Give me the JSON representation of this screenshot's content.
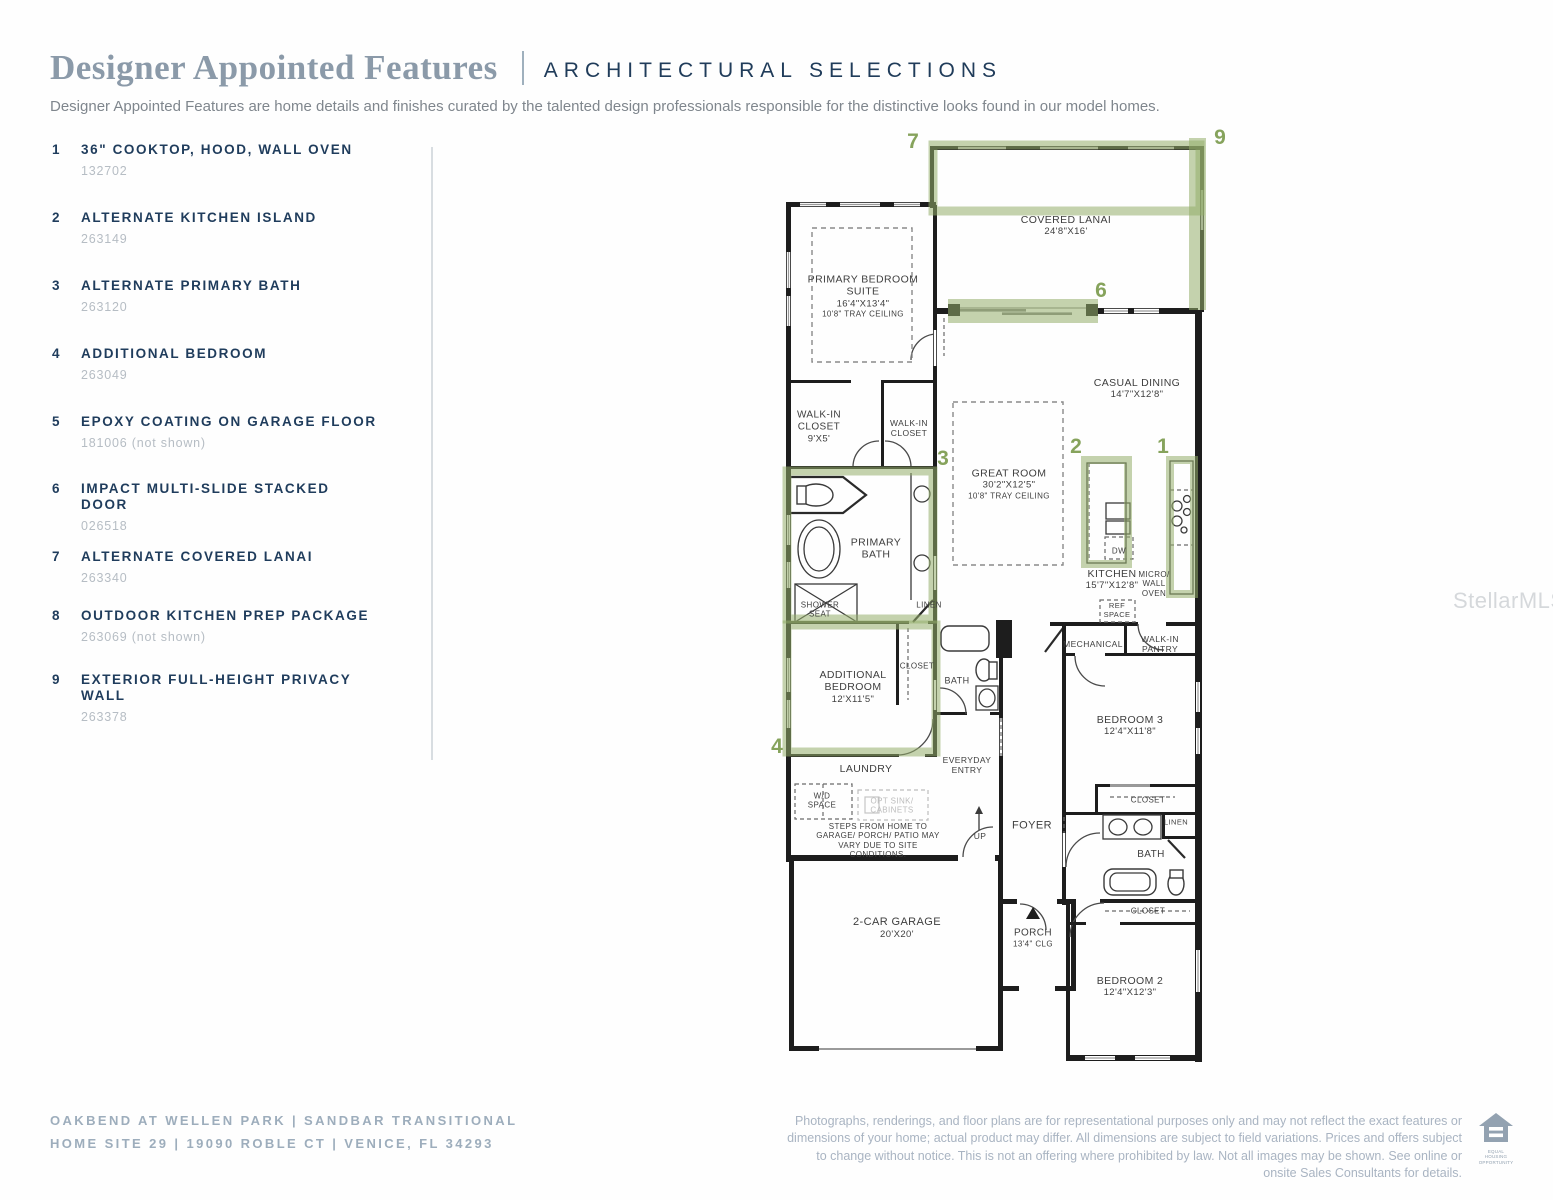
{
  "header": {
    "title": "Designer Appointed Features",
    "subtitle_right": "ARCHITECTURAL SELECTIONS",
    "description": "Designer Appointed Features are home details and finishes curated by the talented design professionals responsible for the distinctive looks found in our model homes."
  },
  "features": [
    {
      "num": "1",
      "title": "36\" COOKTOP, HOOD, WALL OVEN",
      "code": "132702"
    },
    {
      "num": "2",
      "title": "ALTERNATE KITCHEN ISLAND",
      "code": "263149"
    },
    {
      "num": "3",
      "title": "ALTERNATE PRIMARY BATH",
      "code": "263120"
    },
    {
      "num": "4",
      "title": "ADDITIONAL BEDROOM",
      "code": "263049"
    },
    {
      "num": "5",
      "title": "EPOXY COATING ON GARAGE FLOOR",
      "code": "181006 (not shown)"
    },
    {
      "num": "6",
      "title": "IMPACT MULTI-SLIDE STACKED DOOR",
      "code": "026518"
    },
    {
      "num": "7",
      "title": "ALTERNATE COVERED LANAI",
      "code": "263340"
    },
    {
      "num": "8",
      "title": "OUTDOOR KITCHEN PREP PACKAGE",
      "code": "263069 (not shown)"
    },
    {
      "num": "9",
      "title": "EXTERIOR FULL-HEIGHT PRIVACY WALL",
      "code": "263378"
    }
  ],
  "floorplan": {
    "markers": {
      "m1": "1",
      "m2": "2",
      "m3": "3",
      "m4": "4",
      "m6": "6",
      "m7": "7",
      "m9": "9"
    },
    "rooms": {
      "covered_lanai": {
        "name": "COVERED LANAI",
        "dims": "24'8\"X16'"
      },
      "primary_suite": {
        "name": "PRIMARY BEDROOM SUITE",
        "dims": "16'4\"X13'4\"",
        "note": "10'8\" TRAY CEILING"
      },
      "casual_dining": {
        "name": "CASUAL DINING",
        "dims": "14'7\"X12'8\""
      },
      "walkin_closet_1": {
        "name": "WALK-IN CLOSET",
        "dims": "9'X5'"
      },
      "walkin_closet_2": {
        "name": "WALK-IN CLOSET"
      },
      "great_room": {
        "name": "GREAT ROOM",
        "dims": "30'2\"X12'5\"",
        "note": "10'8\" TRAY CEILING"
      },
      "primary_bath": {
        "name": "PRIMARY BATH"
      },
      "shower_seat": {
        "name": "SHOWER SEAT"
      },
      "linen_1": {
        "name": "LINEN"
      },
      "kitchen": {
        "name": "KITCHEN",
        "dims": "15'7\"X12'8\""
      },
      "dw": {
        "name": "DW"
      },
      "micro_wall_oven": {
        "name": "MICRO/ WALL OVEN"
      },
      "ref_space": {
        "name": "REF SPACE"
      },
      "mechanical": {
        "name": "MECHANICAL"
      },
      "walkin_pantry": {
        "name": "WALK-IN PANTRY"
      },
      "additional_bedroom": {
        "name": "ADDITIONAL BEDROOM",
        "dims": "12'X11'5\""
      },
      "closet_a": {
        "name": "CLOSET"
      },
      "bath_1": {
        "name": "BATH"
      },
      "bedroom_3": {
        "name": "BEDROOM 3",
        "dims": "12'4\"X11'8\""
      },
      "laundry": {
        "name": "LAUNDRY"
      },
      "everyday_entry": {
        "name": "EVERYDAY ENTRY"
      },
      "wd_space": {
        "name": "W/D SPACE"
      },
      "opt_sink": {
        "name": "OPT SINK/ CABINETS"
      },
      "steps_note": {
        "name": "STEPS FROM HOME TO GARAGE/ PORCH/ PATIO MAY VARY DUE TO SITE CONDITIONS."
      },
      "up": {
        "name": "UP"
      },
      "foyer": {
        "name": "FOYER"
      },
      "closet_b": {
        "name": "CLOSET"
      },
      "linen_2": {
        "name": "LINEN"
      },
      "bath_2": {
        "name": "BATH"
      },
      "closet_c": {
        "name": "CLOSET"
      },
      "garage": {
        "name": "2-CAR GARAGE",
        "dims": "20'X20'"
      },
      "porch": {
        "name": "PORCH",
        "note": "13'4\" CLG"
      },
      "bedroom_2": {
        "name": "BEDROOM 2",
        "dims": "12'4\"X12'3\""
      }
    }
  },
  "footer": {
    "left_line1": "OAKBEND AT WELLEN PARK  |  SANDBAR TRANSITIONAL",
    "left_line2": "HOME SITE 29  |  19090 ROBLE CT |  VENICE, FL 34293",
    "disclaimer": "Photographs, renderings, and floor plans are for representational purposes only and may not reflect the exact features or dimensions of your home; actual product may differ. All dimensions are subject to field variations. Prices and offers subject to change without notice. This is not an offering where prohibited by law. Not all images may be shown. See online or onsite Sales Consultants for details.",
    "equal_housing": "EQUAL HOUSING OPPORTUNITY"
  },
  "watermark": "StellarMLS"
}
